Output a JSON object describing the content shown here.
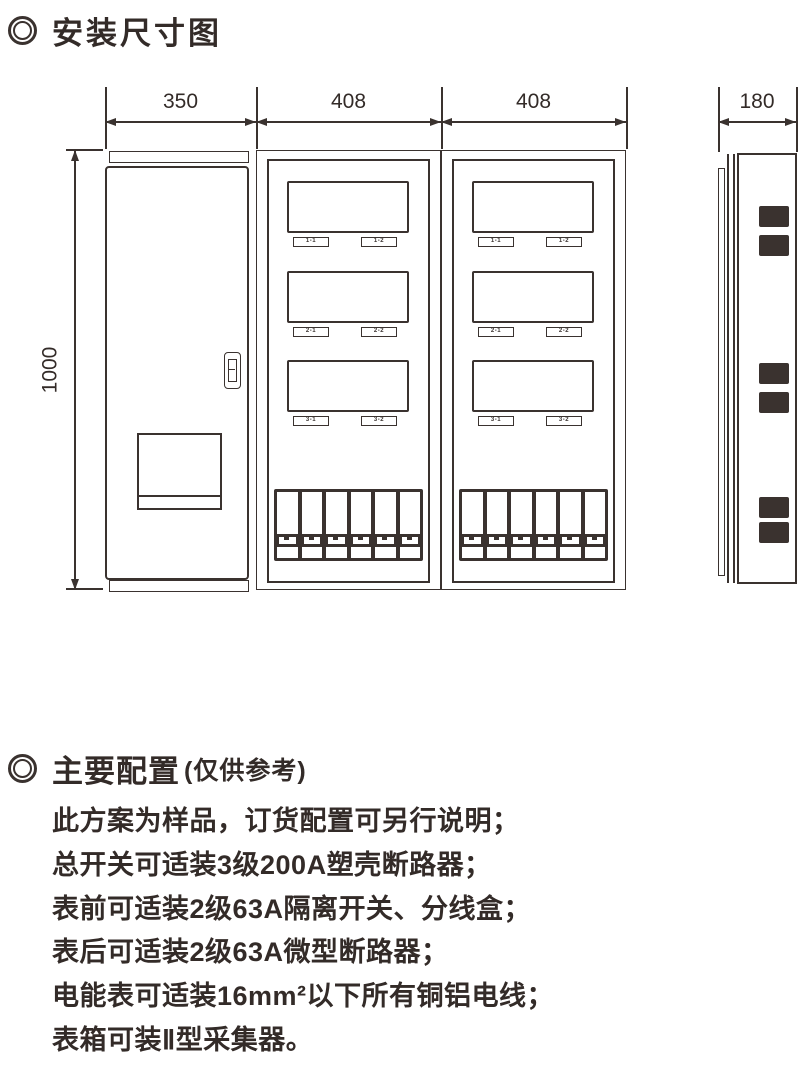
{
  "colors": {
    "ink": "#3a322f"
  },
  "install": {
    "title": "安装尺寸图"
  },
  "diagram": {
    "dims": {
      "door_width": "350",
      "panel1_width": "408",
      "panel2_width": "408",
      "side_depth": "180",
      "height": "1000"
    },
    "left_panel_labels": [
      "1-1",
      "1-2",
      "2-1",
      "2-2",
      "3-1",
      "3-2"
    ],
    "right_panel_labels": [
      "1-1",
      "1-2",
      "2-1",
      "2-2",
      "3-1",
      "3-2"
    ]
  },
  "config": {
    "title": "主要配置",
    "subtitle": "(仅供参考)",
    "lines": [
      "此方案为样品，订货配置可另行说明；",
      "总开关可适装3级200A塑壳断路器；",
      "表前可适装2级63A隔离开关、分线盒；",
      "表后可适装2级63A微型断路器；",
      "电能表可适装16mm²以下所有铜铝电线；",
      "表箱可装Ⅱ型采集器。"
    ]
  }
}
